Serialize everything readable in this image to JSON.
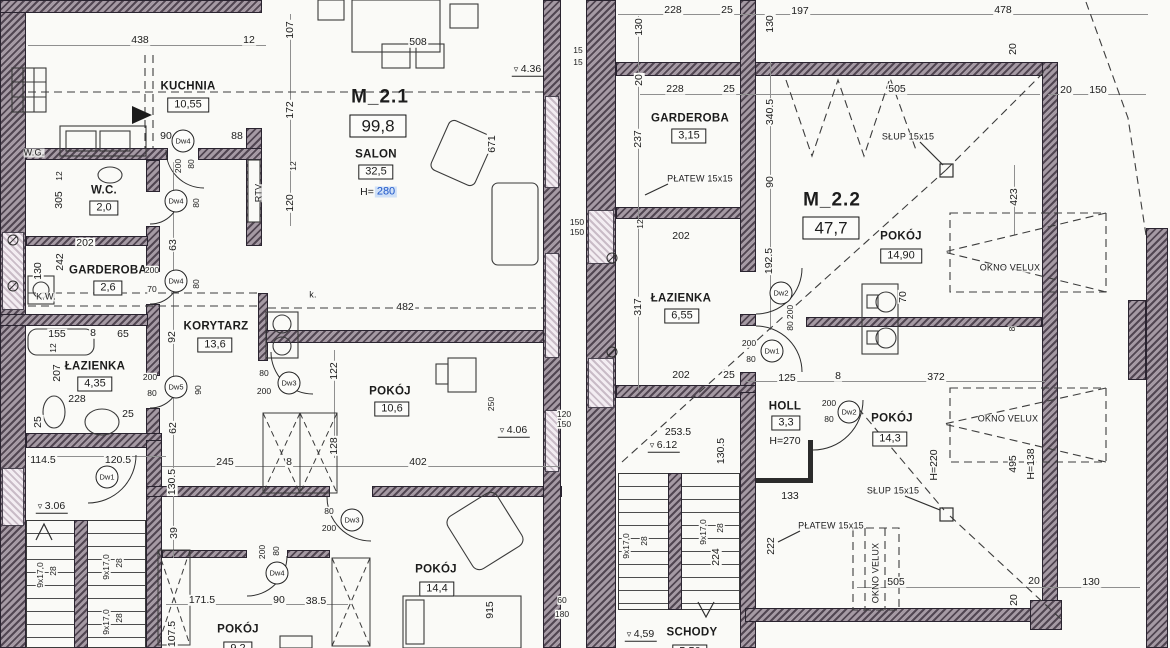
{
  "document": {
    "kind": "architectural floor plan (scan)",
    "units": [
      {
        "id": "M_2.1",
        "area_m2": "99,8",
        "rooms": [
          {
            "name": "KUCHNIA",
            "area": "10,55"
          },
          {
            "name": "SALON",
            "area": "32,5",
            "height": "H=280"
          },
          {
            "name": "W.C.",
            "area": "2,0"
          },
          {
            "name": "GARDEROBA",
            "area": "2,6"
          },
          {
            "name": "ŁAZIENKA",
            "area": "4,35"
          },
          {
            "name": "KORYTARZ",
            "area": "13,6"
          },
          {
            "name": "POKÓJ",
            "area": "10,6"
          },
          {
            "name": "POKÓJ",
            "area": "14,4"
          },
          {
            "name": "POKÓJ",
            "area": "9,2"
          }
        ]
      },
      {
        "id": "M_2.2",
        "area_m2": "47,7",
        "rooms": [
          {
            "name": "GARDEROBA",
            "area": "3,15"
          },
          {
            "name": "ŁAZIENKA",
            "area": "6,55"
          },
          {
            "name": "POKÓJ",
            "area": "14,90"
          },
          {
            "name": "HOLL",
            "area": "3,3",
            "height": "H=270"
          },
          {
            "name": "POKÓJ",
            "area": "14,3",
            "height": "H=220"
          },
          {
            "name": "SCHODY",
            "area": "5,50"
          }
        ]
      }
    ]
  },
  "palette": {
    "paper": "#fafaf7",
    "wall": "#8b7f8a",
    "window": "#c9bcc7",
    "line": "#2e2e2e",
    "highlight_blue": "#1e56c8",
    "highlight_bg": "#cfe0f7"
  },
  "labels": [
    {
      "t": "M_2.1",
      "x": 380,
      "y": 97,
      "k": "unit"
    },
    {
      "t": "99,8",
      "x": 378,
      "y": 126,
      "k": "uarea"
    },
    {
      "t": "SALON",
      "x": 376,
      "y": 155,
      "k": "room"
    },
    {
      "t": "32,5",
      "x": 376,
      "y": 172,
      "k": "area"
    },
    {
      "t": "H=",
      "x": 367,
      "y": 192
    },
    {
      "t": "280",
      "x": 386,
      "y": 192,
      "k": "hl"
    },
    {
      "t": "KUCHNIA",
      "x": 188,
      "y": 87,
      "k": "room"
    },
    {
      "t": "10,55",
      "x": 188,
      "y": 105,
      "k": "area"
    },
    {
      "t": "W.C.",
      "x": 104,
      "y": 191,
      "k": "room"
    },
    {
      "t": "2,0",
      "x": 104,
      "y": 208,
      "k": "area"
    },
    {
      "t": "GARDEROBA",
      "x": 108,
      "y": 271,
      "k": "room"
    },
    {
      "t": "2,6",
      "x": 108,
      "y": 288,
      "k": "area"
    },
    {
      "t": "ŁAZIENKA",
      "x": 95,
      "y": 367,
      "k": "room"
    },
    {
      "t": "4,35",
      "x": 95,
      "y": 384,
      "k": "area"
    },
    {
      "t": "KORYTARZ",
      "x": 216,
      "y": 327,
      "k": "room"
    },
    {
      "t": "13,6",
      "x": 215,
      "y": 345,
      "k": "area"
    },
    {
      "t": "POKÓJ",
      "x": 390,
      "y": 392,
      "k": "room"
    },
    {
      "t": "10,6",
      "x": 392,
      "y": 409,
      "k": "area"
    },
    {
      "t": "POKÓJ",
      "x": 436,
      "y": 570,
      "k": "room"
    },
    {
      "t": "14,4",
      "x": 437,
      "y": 589,
      "k": "area"
    },
    {
      "t": "POKÓJ",
      "x": 238,
      "y": 630,
      "k": "room"
    },
    {
      "t": "9,2",
      "x": 238,
      "y": 649,
      "k": "area"
    },
    {
      "t": "M_2.2",
      "x": 832,
      "y": 200,
      "k": "unit"
    },
    {
      "t": "47,7",
      "x": 831,
      "y": 228,
      "k": "uarea"
    },
    {
      "t": "GARDEROBA",
      "x": 690,
      "y": 119,
      "k": "room"
    },
    {
      "t": "3,15",
      "x": 689,
      "y": 136,
      "k": "area"
    },
    {
      "t": "ŁAZIENKA",
      "x": 681,
      "y": 299,
      "k": "room"
    },
    {
      "t": "6,55",
      "x": 682,
      "y": 316,
      "k": "area"
    },
    {
      "t": "POKÓJ",
      "x": 901,
      "y": 237,
      "k": "room"
    },
    {
      "t": "14,90",
      "x": 901,
      "y": 256,
      "k": "area"
    },
    {
      "t": "HOLL",
      "x": 785,
      "y": 407,
      "k": "room"
    },
    {
      "t": "3,3",
      "x": 786,
      "y": 423,
      "k": "area"
    },
    {
      "t": "H=270",
      "x": 785,
      "y": 441
    },
    {
      "t": "POKÓJ",
      "x": 892,
      "y": 419,
      "k": "room"
    },
    {
      "t": "14,3",
      "x": 890,
      "y": 439,
      "k": "area"
    },
    {
      "t": "SCHODY",
      "x": 692,
      "y": 633,
      "k": "room"
    },
    {
      "t": "5,50",
      "x": 690,
      "y": 652,
      "k": "area"
    },
    {
      "t": "OKNO VELUX",
      "x": 1010,
      "y": 268,
      "k": "note"
    },
    {
      "t": "OKNO VELUX",
      "x": 1008,
      "y": 419,
      "k": "note"
    },
    {
      "t": "OKNO VELUX",
      "x": 876,
      "y": 573,
      "k": "note",
      "r": -90
    },
    {
      "t": "SŁUP 15x15",
      "x": 908,
      "y": 137,
      "k": "note"
    },
    {
      "t": "SŁUP 15x15",
      "x": 893,
      "y": 491,
      "k": "note"
    },
    {
      "t": "PŁATEW 15x15",
      "x": 700,
      "y": 179,
      "k": "note"
    },
    {
      "t": "PŁATEW 15x15",
      "x": 831,
      "y": 526,
      "k": "note"
    },
    {
      "t": "RTV",
      "x": 259,
      "y": 193,
      "k": "note",
      "r": -90
    },
    {
      "t": "W.G.",
      "x": 34,
      "y": 153,
      "k": "note"
    },
    {
      "t": "K.W.",
      "x": 46,
      "y": 297,
      "k": "note"
    },
    {
      "t": "k.",
      "x": 313,
      "y": 295,
      "k": "note"
    },
    {
      "t": "3.06",
      "x": 52,
      "y": 507,
      "k": "level"
    },
    {
      "t": "4.36",
      "x": 528,
      "y": 70,
      "k": "level"
    },
    {
      "t": "4.06",
      "x": 514,
      "y": 431,
      "k": "level"
    },
    {
      "t": "6.12",
      "x": 664,
      "y": 446,
      "k": "level"
    },
    {
      "t": "4,59",
      "x": 641,
      "y": 635,
      "k": "level"
    },
    {
      "t": "Dw4",
      "x": 183,
      "y": 141,
      "k": "door"
    },
    {
      "t": "Dw4",
      "x": 176,
      "y": 201,
      "k": "door"
    },
    {
      "t": "Dw4",
      "x": 176,
      "y": 281,
      "k": "door"
    },
    {
      "t": "Dw5",
      "x": 176,
      "y": 387,
      "k": "door"
    },
    {
      "t": "Dw1",
      "x": 107,
      "y": 477,
      "k": "door"
    },
    {
      "t": "Dw3",
      "x": 289,
      "y": 383,
      "k": "door"
    },
    {
      "t": "Dw3",
      "x": 352,
      "y": 520,
      "k": "door"
    },
    {
      "t": "Dw4",
      "x": 277,
      "y": 573,
      "k": "door"
    },
    {
      "t": "Dw1",
      "x": 772,
      "y": 351,
      "k": "door"
    },
    {
      "t": "Dw2",
      "x": 781,
      "y": 293,
      "k": "door"
    },
    {
      "t": "Dw2",
      "x": 849,
      "y": 412,
      "k": "door"
    },
    {
      "t": "438",
      "x": 140,
      "y": 40
    },
    {
      "t": "12",
      "x": 249,
      "y": 40
    },
    {
      "t": "242",
      "x": 60,
      "y": 262,
      "r": -90
    },
    {
      "t": "90",
      "x": 166,
      "y": 136
    },
    {
      "t": "88",
      "x": 237,
      "y": 136
    },
    {
      "t": "107",
      "x": 290,
      "y": 30,
      "r": -90
    },
    {
      "t": "172",
      "x": 290,
      "y": 110,
      "r": -90
    },
    {
      "t": "12",
      "x": 293,
      "y": 166,
      "r": -90,
      "k": "sdim"
    },
    {
      "t": "120",
      "x": 290,
      "y": 203,
      "r": -90
    },
    {
      "t": "508",
      "x": 418,
      "y": 42
    },
    {
      "t": "671",
      "x": 492,
      "y": 144,
      "r": -90
    },
    {
      "t": "15",
      "x": 578,
      "y": 50,
      "k": "sdim"
    },
    {
      "t": "15",
      "x": 578,
      "y": 62,
      "k": "sdim"
    },
    {
      "t": "305",
      "x": 59,
      "y": 200,
      "r": -90
    },
    {
      "t": "12",
      "x": 59,
      "y": 176,
      "r": -90,
      "k": "sdim"
    },
    {
      "t": "200",
      "x": 178,
      "y": 166,
      "r": -90,
      "k": "sdim"
    },
    {
      "t": "80",
      "x": 191,
      "y": 164,
      "r": -90,
      "k": "sdim"
    },
    {
      "t": "202",
      "x": 85,
      "y": 243
    },
    {
      "t": "130",
      "x": 38,
      "y": 271,
      "r": -90
    },
    {
      "t": "63",
      "x": 173,
      "y": 245,
      "r": -90
    },
    {
      "t": "80",
      "x": 196,
      "y": 203,
      "r": -90,
      "k": "sdim"
    },
    {
      "t": "200",
      "x": 152,
      "y": 270,
      "k": "sdim"
    },
    {
      "t": "70",
      "x": 152,
      "y": 289,
      "k": "sdim"
    },
    {
      "t": "80",
      "x": 196,
      "y": 284,
      "r": -90,
      "k": "sdim"
    },
    {
      "t": "155",
      "x": 57,
      "y": 334
    },
    {
      "t": "8",
      "x": 93,
      "y": 333
    },
    {
      "t": "65",
      "x": 123,
      "y": 334
    },
    {
      "t": "12",
      "x": 53,
      "y": 348,
      "r": -90,
      "k": "sdim"
    },
    {
      "t": "207",
      "x": 57,
      "y": 373,
      "r": -90
    },
    {
      "t": "228",
      "x": 77,
      "y": 399
    },
    {
      "t": "25",
      "x": 38,
      "y": 422,
      "r": -90
    },
    {
      "t": "25",
      "x": 128,
      "y": 414
    },
    {
      "t": "200",
      "x": 150,
      "y": 377,
      "k": "sdim"
    },
    {
      "t": "80",
      "x": 152,
      "y": 393,
      "k": "sdim"
    },
    {
      "t": "90",
      "x": 198,
      "y": 390,
      "r": -90,
      "k": "sdim"
    },
    {
      "t": "92",
      "x": 172,
      "y": 337,
      "r": -90
    },
    {
      "t": "62",
      "x": 173,
      "y": 428,
      "r": -90
    },
    {
      "t": "114.5",
      "x": 43,
      "y": 460
    },
    {
      "t": "120.5",
      "x": 118,
      "y": 460
    },
    {
      "t": "130.5",
      "x": 172,
      "y": 482,
      "r": -90
    },
    {
      "t": "39",
      "x": 174,
      "y": 533,
      "r": -90
    },
    {
      "t": "9x17,0",
      "x": 40,
      "y": 575,
      "r": -90,
      "k": "sdim"
    },
    {
      "t": "28",
      "x": 53,
      "y": 571,
      "r": -90,
      "k": "sdim"
    },
    {
      "t": "9x17,0",
      "x": 106,
      "y": 567,
      "r": -90,
      "k": "sdim"
    },
    {
      "t": "28",
      "x": 119,
      "y": 563,
      "r": -90,
      "k": "sdim"
    },
    {
      "t": "9x17,0",
      "x": 106,
      "y": 622,
      "r": -90,
      "k": "sdim"
    },
    {
      "t": "28",
      "x": 119,
      "y": 618,
      "r": -90,
      "k": "sdim"
    },
    {
      "t": "171.5",
      "x": 202,
      "y": 600
    },
    {
      "t": "90",
      "x": 279,
      "y": 600
    },
    {
      "t": "38.5",
      "x": 316,
      "y": 601
    },
    {
      "t": "107.5",
      "x": 172,
      "y": 634,
      "r": -90
    },
    {
      "t": "200",
      "x": 262,
      "y": 552,
      "r": -90,
      "k": "sdim"
    },
    {
      "t": "80",
      "x": 276,
      "y": 551,
      "r": -90,
      "k": "sdim"
    },
    {
      "t": "80",
      "x": 329,
      "y": 511,
      "k": "sdim"
    },
    {
      "t": "200",
      "x": 329,
      "y": 528,
      "k": "sdim"
    },
    {
      "t": "80",
      "x": 264,
      "y": 373,
      "k": "sdim"
    },
    {
      "t": "200",
      "x": 264,
      "y": 391,
      "k": "sdim"
    },
    {
      "t": "122",
      "x": 334,
      "y": 371,
      "r": -90
    },
    {
      "t": "482",
      "x": 405,
      "y": 307
    },
    {
      "t": "128",
      "x": 334,
      "y": 446,
      "r": -90
    },
    {
      "t": "8",
      "x": 289,
      "y": 462
    },
    {
      "t": "245",
      "x": 225,
      "y": 462
    },
    {
      "t": "402",
      "x": 418,
      "y": 462
    },
    {
      "t": "915",
      "x": 490,
      "y": 610,
      "r": -90
    },
    {
      "t": "60",
      "x": 562,
      "y": 600,
      "k": "sdim"
    },
    {
      "t": "180",
      "x": 562,
      "y": 614,
      "k": "sdim"
    },
    {
      "t": "250",
      "x": 491,
      "y": 404,
      "r": -90,
      "k": "sdim"
    },
    {
      "t": "150",
      "x": 577,
      "y": 222,
      "k": "sdim"
    },
    {
      "t": "150",
      "x": 577,
      "y": 232,
      "k": "sdim"
    },
    {
      "t": "120",
      "x": 564,
      "y": 414,
      "k": "sdim"
    },
    {
      "t": "150",
      "x": 564,
      "y": 424,
      "k": "sdim"
    },
    {
      "t": "228",
      "x": 673,
      "y": 10
    },
    {
      "t": "25",
      "x": 727,
      "y": 10
    },
    {
      "t": "197",
      "x": 800,
      "y": 11
    },
    {
      "t": "478",
      "x": 1003,
      "y": 10
    },
    {
      "t": "130",
      "x": 639,
      "y": 27,
      "r": -90
    },
    {
      "t": "130",
      "x": 770,
      "y": 24,
      "r": -90
    },
    {
      "t": "20",
      "x": 639,
      "y": 80,
      "r": -90
    },
    {
      "t": "228",
      "x": 675,
      "y": 89
    },
    {
      "t": "25",
      "x": 729,
      "y": 89
    },
    {
      "t": "505",
      "x": 897,
      "y": 89
    },
    {
      "t": "20",
      "x": 1013,
      "y": 49,
      "r": -90
    },
    {
      "t": "20",
      "x": 1066,
      "y": 90
    },
    {
      "t": "150",
      "x": 1098,
      "y": 90
    },
    {
      "t": "237",
      "x": 638,
      "y": 139,
      "r": -90
    },
    {
      "t": "340.5",
      "x": 770,
      "y": 112,
      "r": -90
    },
    {
      "t": "90",
      "x": 770,
      "y": 182,
      "r": -90
    },
    {
      "t": "423",
      "x": 1014,
      "y": 197,
      "r": -90
    },
    {
      "t": "12",
      "x": 640,
      "y": 224,
      "r": -90,
      "k": "sdim"
    },
    {
      "t": "202",
      "x": 681,
      "y": 236
    },
    {
      "t": "317",
      "x": 638,
      "y": 307,
      "r": -90
    },
    {
      "t": "192.5",
      "x": 769,
      "y": 261,
      "r": -90
    },
    {
      "t": "200",
      "x": 790,
      "y": 312,
      "r": -90,
      "k": "sdim"
    },
    {
      "t": "80",
      "x": 790,
      "y": 326,
      "r": -90,
      "k": "sdim"
    },
    {
      "t": "70",
      "x": 903,
      "y": 297,
      "r": -90
    },
    {
      "t": "202",
      "x": 681,
      "y": 375
    },
    {
      "t": "25",
      "x": 729,
      "y": 375
    },
    {
      "t": "125",
      "x": 787,
      "y": 378
    },
    {
      "t": "8",
      "x": 838,
      "y": 376
    },
    {
      "t": "372",
      "x": 936,
      "y": 377
    },
    {
      "t": "8",
      "x": 1012,
      "y": 329,
      "r": -90,
      "k": "sdim"
    },
    {
      "t": "200",
      "x": 749,
      "y": 343,
      "k": "sdim"
    },
    {
      "t": "80",
      "x": 751,
      "y": 359,
      "k": "sdim"
    },
    {
      "t": "200",
      "x": 829,
      "y": 403,
      "k": "sdim"
    },
    {
      "t": "80",
      "x": 829,
      "y": 419,
      "k": "sdim"
    },
    {
      "t": "253.5",
      "x": 678,
      "y": 432
    },
    {
      "t": "130.5",
      "x": 721,
      "y": 451,
      "r": -90
    },
    {
      "t": "133",
      "x": 790,
      "y": 496
    },
    {
      "t": "222",
      "x": 771,
      "y": 546,
      "r": -90
    },
    {
      "t": "H=220",
      "x": 934,
      "y": 465,
      "r": -90
    },
    {
      "t": "495",
      "x": 1013,
      "y": 464,
      "r": -90
    },
    {
      "t": "H=138",
      "x": 1031,
      "y": 464,
      "r": -90
    },
    {
      "t": "9x17,0",
      "x": 626,
      "y": 546,
      "r": -90,
      "k": "sdim"
    },
    {
      "t": "28",
      "x": 644,
      "y": 541,
      "r": -90,
      "k": "sdim"
    },
    {
      "t": "9x17,0",
      "x": 703,
      "y": 532,
      "r": -90,
      "k": "sdim"
    },
    {
      "t": "28",
      "x": 720,
      "y": 528,
      "r": -90,
      "k": "sdim"
    },
    {
      "t": "224",
      "x": 716,
      "y": 557,
      "r": -90
    },
    {
      "t": "505",
      "x": 896,
      "y": 582
    },
    {
      "t": "20",
      "x": 1034,
      "y": 581
    },
    {
      "t": "130",
      "x": 1091,
      "y": 582
    },
    {
      "t": "20",
      "x": 1014,
      "y": 600,
      "r": -90
    }
  ]
}
